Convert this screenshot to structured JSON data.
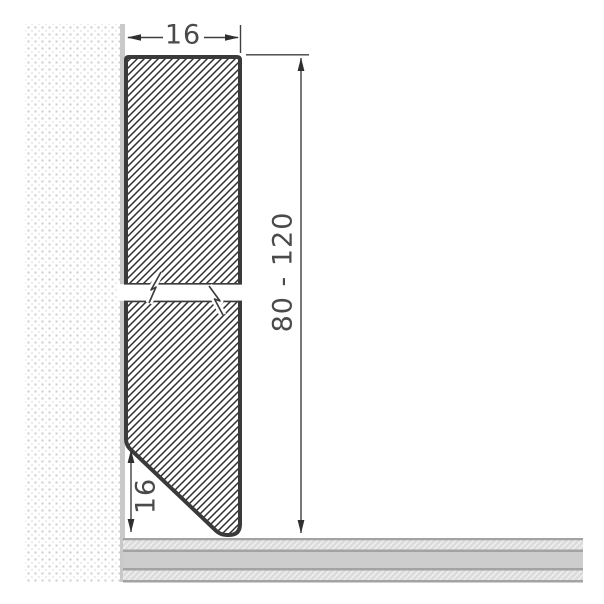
{
  "figure": {
    "title": "skirting-profile-cross-section-drawing",
    "dimension_labels": {
      "top_width": "16",
      "height_range": "80 - 120",
      "bottom_bevel_height": "16"
    },
    "parts": {
      "wall": "dotted-wall-section",
      "profile": "hatched-skirting-profile-with-break",
      "floor": "layered-floor-section"
    },
    "colors": {
      "profile_outline": "#3a3a3a",
      "profile_hatch": "#2e2e2e",
      "dimension_lines": "#3f3f3f",
      "dimension_text": "#4a4a4a",
      "wall_face": "#c9c9c9",
      "wall_dots": "#cccccc",
      "floor_border": "#a3a3a3",
      "floor_plain_band": "#cdcdcd",
      "floor_hatch_band": "#dcdcdc",
      "background": "#ffffff"
    }
  }
}
